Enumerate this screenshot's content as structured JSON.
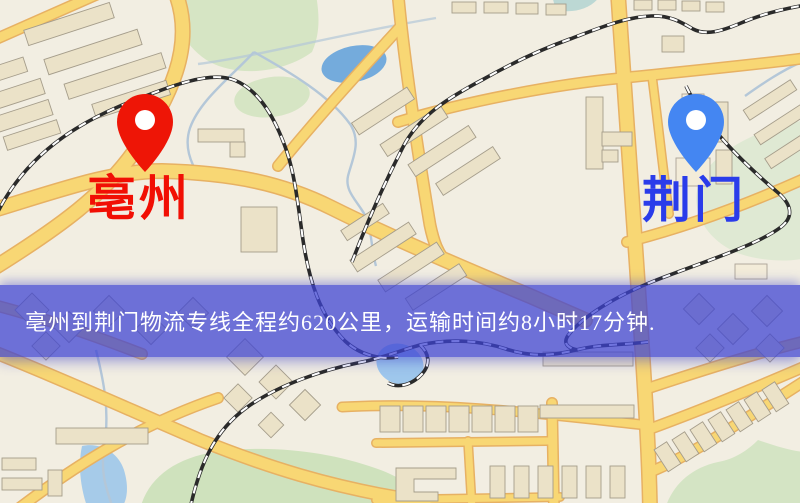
{
  "route_banner": {
    "text": "亳州到荆门物流专线全程约620公里，运输时间约8小时17分钟.",
    "distance_km": 620,
    "duration": "8小时17分钟",
    "background_color": "#3e44d2",
    "text_color": "#ffffff"
  },
  "markers": {
    "origin": {
      "label": "亳州",
      "pin_color": "#ee1506",
      "label_color": "#f10f04"
    },
    "destination": {
      "label": "荆门",
      "pin_color": "#4486f2",
      "label_color": "#2a3cea"
    }
  },
  "map_theme": {
    "background": "#f2eee2",
    "road_fill": "#f8d774",
    "road_casing": "#e7b163",
    "park": "#d6e5c4",
    "water": "#74abdc",
    "railway": "#2a2a2a"
  }
}
